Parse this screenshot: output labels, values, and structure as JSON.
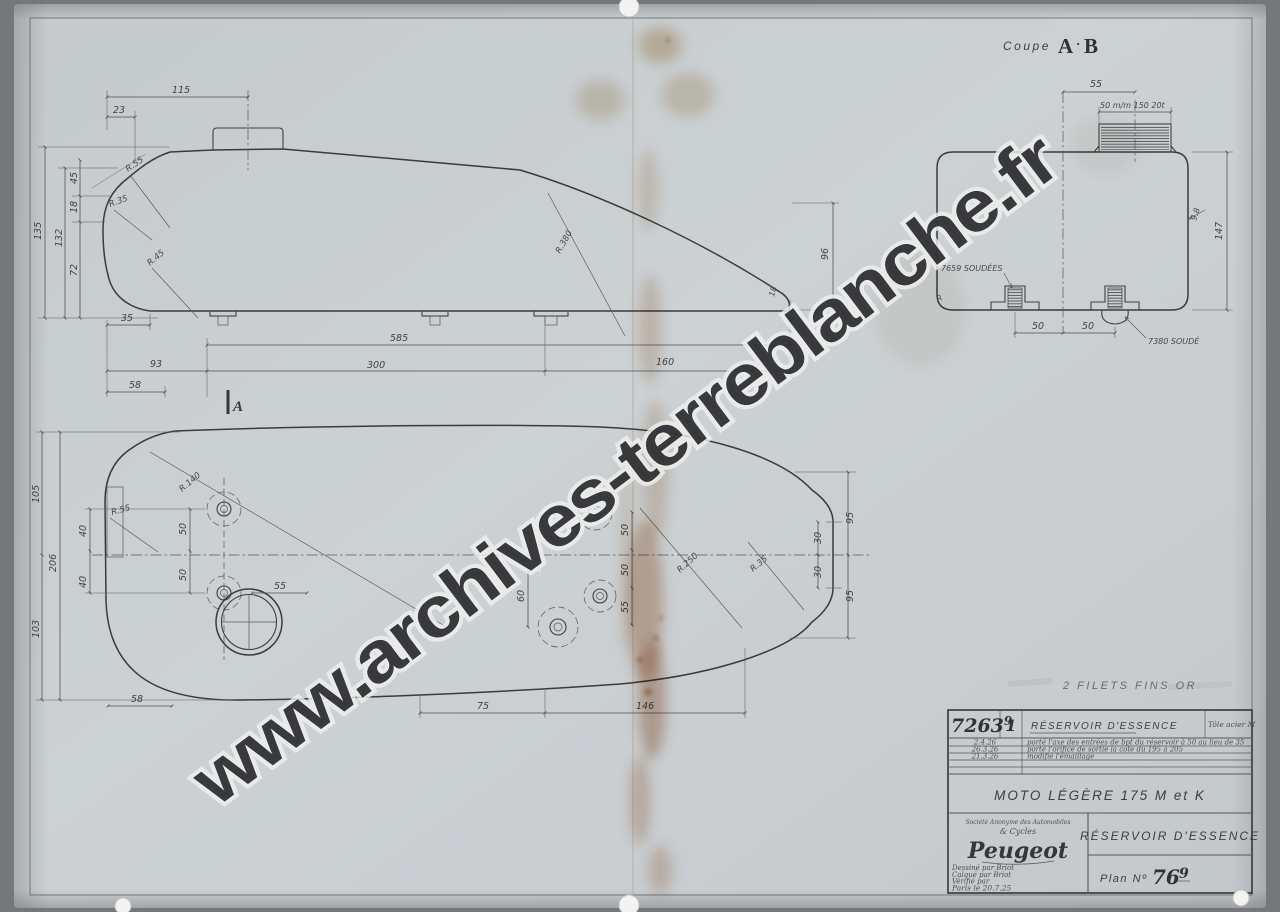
{
  "watermark": "www.archives-terreblanche.fr",
  "coupe_title": {
    "label": "Coupe",
    "a": "A",
    "sep": "·",
    "b": "B"
  },
  "note_filets": "2 FILETS FINS OR",
  "side_view": {
    "d115": "115",
    "d23": "23",
    "d135": "135",
    "d132": "132",
    "d45": "45",
    "d18": "18",
    "d72": "72",
    "d35": "35",
    "d585": "585",
    "d93": "93",
    "d300": "300",
    "d160": "160",
    "d58": "58",
    "d96": "96",
    "d_tail": "18",
    "r_top": "R.55",
    "r_front": "R.35",
    "r_bottom": "R.45",
    "r_sweep": "R.380",
    "section_marker": "A"
  },
  "plan_view": {
    "d206": "206",
    "d105": "105",
    "d103": "103",
    "d40a": "40",
    "d40b": "40",
    "d50a": "50",
    "d50b": "50",
    "d50c": "50",
    "d50d": "50",
    "d55c": "55",
    "d60": "60",
    "d55": "55",
    "d58": "58",
    "d75": "75",
    "d146": "146",
    "d95a": "95",
    "d95b": "95",
    "d30a": "30",
    "d30b": "30",
    "r_140": "R.140",
    "r_nose": "R.55",
    "r_sweep": "R.250",
    "r_tail": "R.35"
  },
  "section_view": {
    "d55": "55",
    "thread": "50 m/m 150 20t",
    "d98": "9.8",
    "d147": "147",
    "d50a": "50",
    "d50b": "50",
    "weld_left": "7659 SOUDÉES",
    "weld_right": "7380 SOUDÉ",
    "r_corner": "R"
  },
  "title_block": {
    "drawing_number": "7263",
    "drawing_number_sup": "9",
    "sheet_index": "1",
    "part_name": "RÉSERVOIR D'ESSENCE",
    "material": "Tôle acier M",
    "revisions": [
      {
        "date": "2.4.26",
        "note": "porté l'axe des entrées de bpt du réservoir à 50 au lieu de 35"
      },
      {
        "date": "26.3.26",
        "note": "porté l'orifice de sortie la cote du 195 à 205"
      },
      {
        "date": "21.3.26",
        "note": "modifié l'émaillage"
      }
    ],
    "model": "MOTO LÉGÈRE 175 M et K",
    "company_line1": "Société Anonyme des Automobiles",
    "company_line2": "& Cycles",
    "company_name": "Peugeot",
    "drawn_by": "Dessiné par Briot",
    "traced_by": "Calqué par Briot",
    "checked_by": "Vérifié par",
    "place_date": "Paris le 20.7.25",
    "part_title": "RÉSERVOIR D'ESSENCE",
    "plan_label": "Plan Nº",
    "plan_number_main": "76",
    "plan_number_sup": "9"
  },
  "colors": {
    "paper": "#cbd0d3",
    "ink": "#383b3f",
    "stain": "#a35f2f"
  }
}
